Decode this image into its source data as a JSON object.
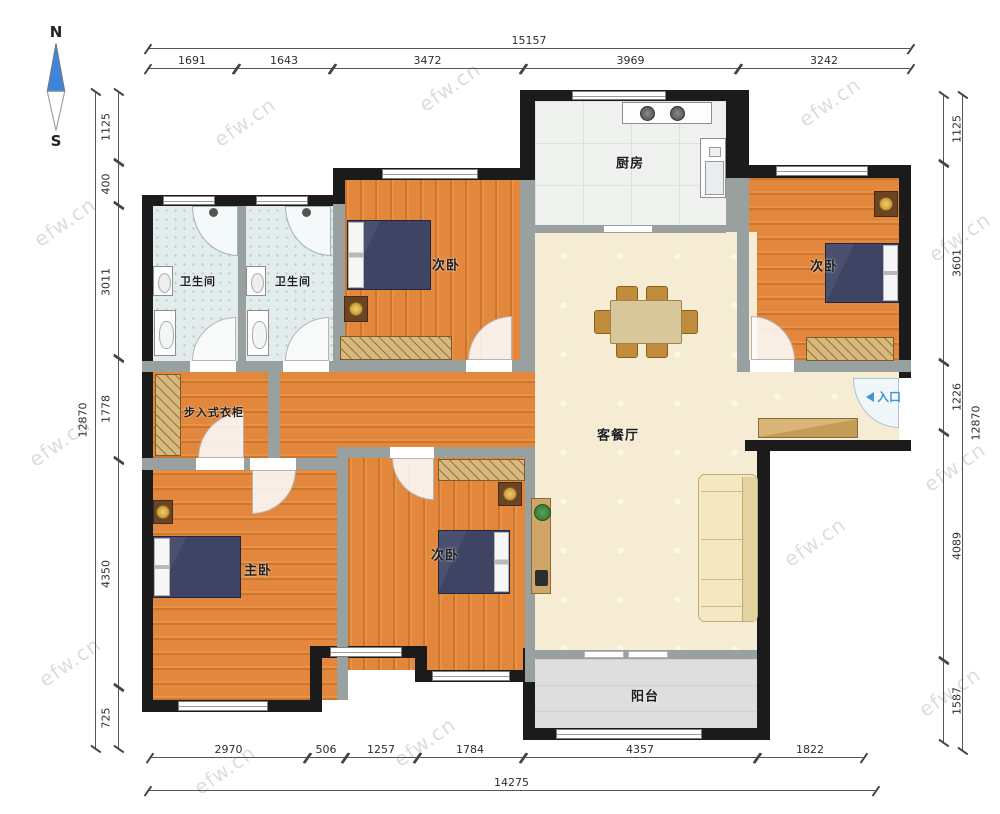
{
  "compass": {
    "north": "N",
    "south": "S"
  },
  "watermark": "efw.cn",
  "rooms": {
    "bathroom1": "卫生间",
    "bathroom2": "卫生间",
    "bedroom_top": "次卧",
    "kitchen": "厨房",
    "bedroom_right": "次卧",
    "living_dining": "客餐厅",
    "closet": "步入式衣柜",
    "master": "主卧",
    "bedroom_mid": "次卧",
    "balcony": "阳台",
    "entrance": "入口"
  },
  "dims": {
    "top": {
      "overall": "15157",
      "segments": [
        "1691",
        "1643",
        "3472",
        "3969",
        "3242"
      ]
    },
    "bottom": {
      "overall": "14275",
      "segments": [
        "2970",
        "506",
        "1257",
        "1784",
        "4357",
        "1822"
      ]
    },
    "left": {
      "overall": "12870",
      "segments": [
        "1125",
        "400",
        "3011",
        "1778",
        "4350",
        "725"
      ]
    },
    "right": {
      "overall": "12870",
      "segments": [
        "1125",
        "3601",
        "1226",
        "4089",
        "1587"
      ]
    }
  }
}
